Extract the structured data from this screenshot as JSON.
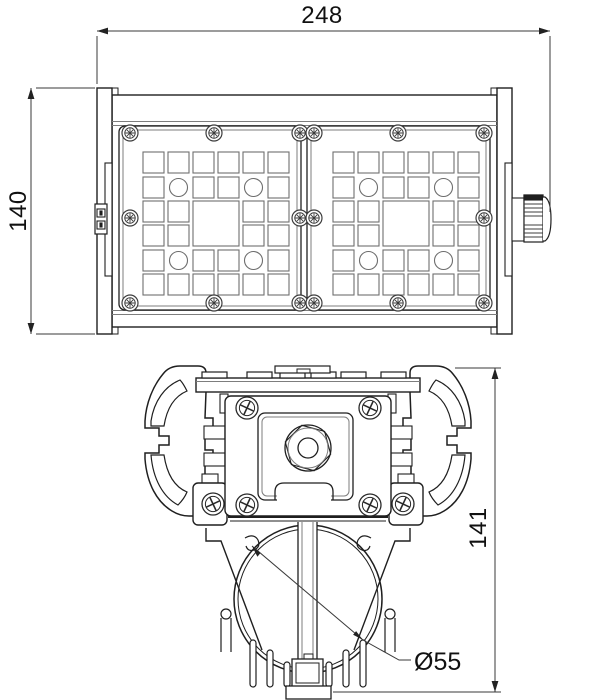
{
  "dimensions": {
    "width": "248",
    "front_height": "140",
    "side_height": "141",
    "tube_diameter": "Ø55"
  },
  "colors": {
    "line": "#1f1f1f",
    "dim_line": "#3a3a3a",
    "detail_gray": "#7d7d7d",
    "background": "#ffffff"
  }
}
